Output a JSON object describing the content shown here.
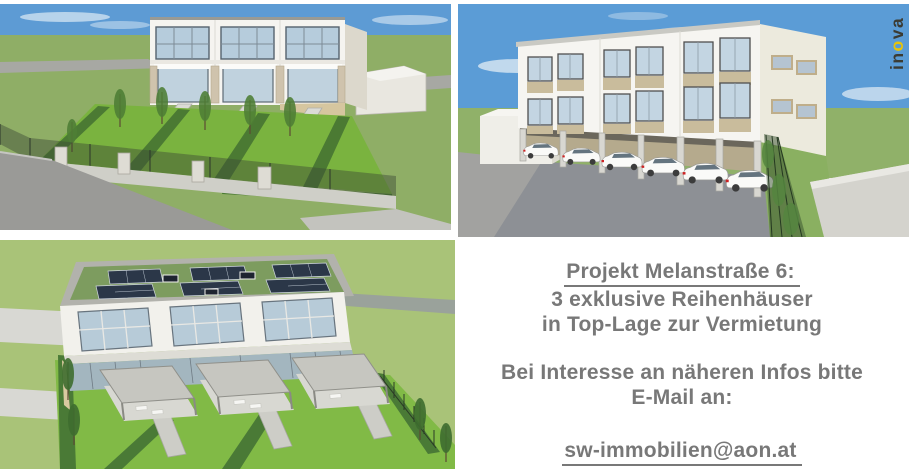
{
  "logo": {
    "pre": "in",
    "o": "o",
    "post": "va",
    "full_text": "inova",
    "color_dark": "#3b3b33",
    "color_o": "#e9c408"
  },
  "info_panel": {
    "title": "Projekt Melanstraße 6:",
    "subtitle1": "3 exklusive Reihenhäuser",
    "subtitle2": "in Top-Lage zur Vermietung",
    "contact1": "Bei Interesse an näheren Infos bitte",
    "contact2": "E-Mail an:",
    "email": "sw-immobilien@aon.at",
    "text_color": "#787878"
  },
  "renders": {
    "garden_view": "render-garden-view",
    "carport_view": "render-carport-view",
    "aerial_view": "render-aerial-view"
  },
  "colors": {
    "sky_blue": "#5b9cd6",
    "field_green": "#8fae66",
    "lawn_green": "#7ab33f",
    "hedge_green": "#4b7a33",
    "asphalt_gray": "#8d9095",
    "building_white": "#f5f4f0",
    "spandrel_beige": "#c9bc9c"
  }
}
